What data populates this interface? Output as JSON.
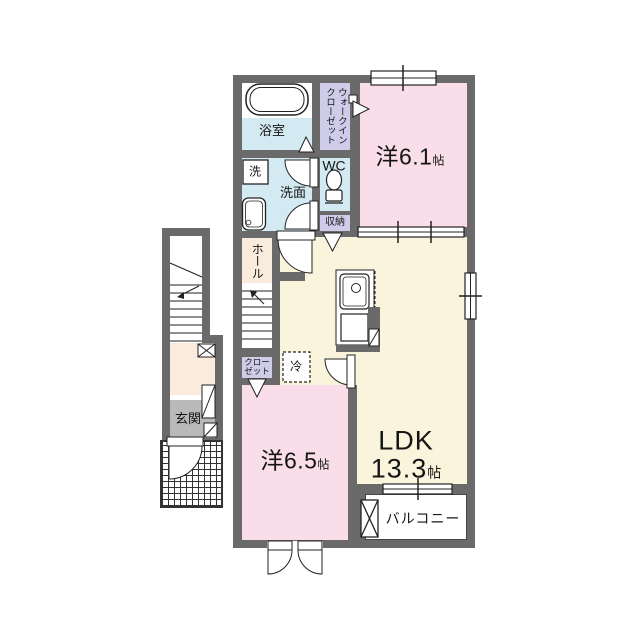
{
  "document": {
    "type": "floor-plan",
    "language": "ja"
  },
  "colors": {
    "wall": "#6a6a6a",
    "line": "#222222",
    "pink": "#f9dde8",
    "cream": "#fbf4dc",
    "peach": "#f9ecdd",
    "blue": "#d4eaf2",
    "lavender": "#cfccea",
    "genkan": "#b9b9b9",
    "white": "#ffffff"
  },
  "rooms": {
    "bathroom": {
      "label": "浴室"
    },
    "walk_in_closet": {
      "label_line1": "ウォークイン",
      "label_line2": "クローゼット"
    },
    "western_room_1": {
      "name": "洋",
      "size": "6.1",
      "unit": "帖"
    },
    "laundry": {
      "label": "洗"
    },
    "washroom": {
      "label": "洗面"
    },
    "wc": {
      "label": "WC"
    },
    "storage": {
      "label": "収納"
    },
    "hall": {
      "label": "ホール"
    },
    "closet": {
      "label_line1": "クロー",
      "label_line2": "ゼット"
    },
    "refrigerator": {
      "label": "冷"
    },
    "ldk": {
      "name": "LDK",
      "size": "13.3",
      "unit": "帖"
    },
    "western_room_2": {
      "name": "洋",
      "size": "6.5",
      "unit": "帖"
    },
    "entrance": {
      "label": "玄関"
    },
    "balcony": {
      "label": "バルコニー"
    }
  }
}
